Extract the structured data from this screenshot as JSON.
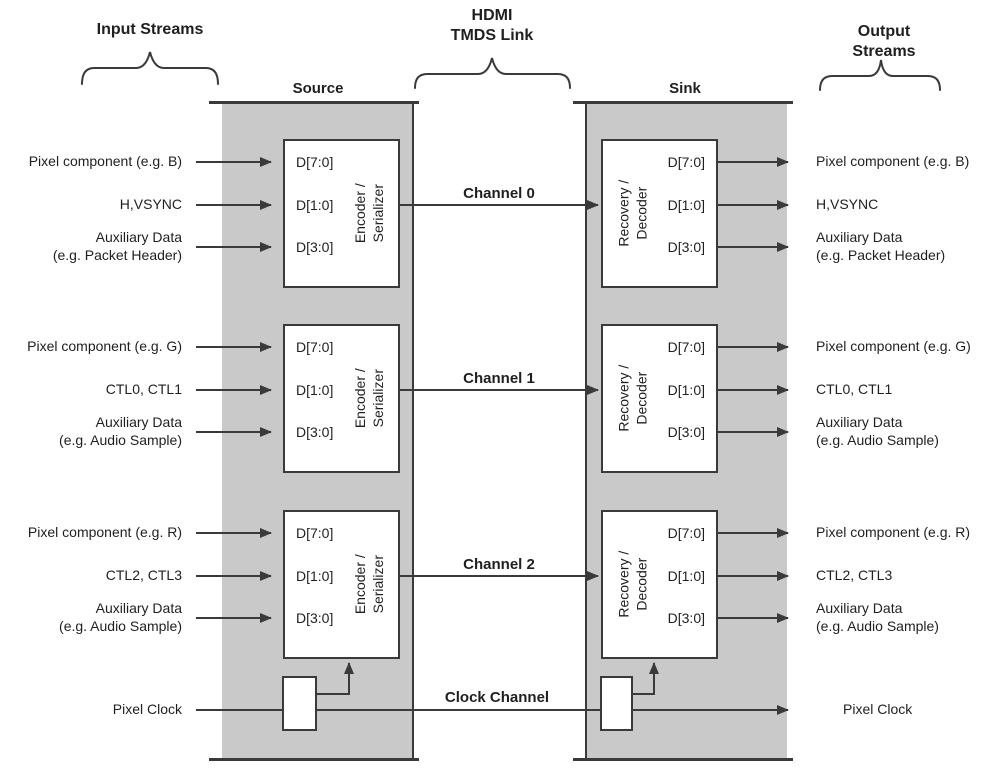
{
  "header": {
    "input_streams": "Input Streams",
    "hdmi_link": "HDMI\nTMDS Link",
    "output_streams": "Output Streams",
    "source": "Source",
    "sink": "Sink"
  },
  "channels": [
    {
      "name": "Channel 0",
      "encoder": "Encoder /\nSerializer",
      "decoder": "Recovery /\nDecoder",
      "ports": [
        "D[7:0]",
        "D[1:0]",
        "D[3:0]"
      ],
      "inputs": [
        "Pixel component (e.g. B)",
        "H,VSYNC",
        "Auxiliary Data\n(e.g. Packet Header)"
      ],
      "outputs": [
        "Pixel component (e.g. B)",
        "H,VSYNC",
        "Auxiliary Data\n(e.g. Packet Header)"
      ]
    },
    {
      "name": "Channel 1",
      "encoder": "Encoder /\nSerializer",
      "decoder": "Recovery /\nDecoder",
      "ports": [
        "D[7:0]",
        "D[1:0]",
        "D[3:0]"
      ],
      "inputs": [
        "Pixel component (e.g. G)",
        "CTL0, CTL1",
        "Auxiliary Data\n(e.g. Audio Sample)"
      ],
      "outputs": [
        "Pixel component (e.g. G)",
        "CTL0, CTL1",
        "Auxiliary Data\n(e.g. Audio Sample)"
      ]
    },
    {
      "name": "Channel 2",
      "encoder": "Encoder /\nSerializer",
      "decoder": "Recovery /\nDecoder",
      "ports": [
        "D[7:0]",
        "D[1:0]",
        "D[3:0]"
      ],
      "inputs": [
        "Pixel component (e.g. R)",
        "CTL2, CTL3",
        "Auxiliary Data\n(e.g. Audio Sample)"
      ],
      "outputs": [
        "Pixel component (e.g. R)",
        "CTL2, CTL3",
        "Auxiliary Data\n(e.g. Audio Sample)"
      ]
    }
  ],
  "clock": {
    "name": "Clock Channel",
    "input": "Pixel Clock",
    "output": "Pixel Clock"
  },
  "colors": {
    "band": "#c9c9c9",
    "line": "#3a3a3a",
    "text": "#1f1f1f"
  }
}
